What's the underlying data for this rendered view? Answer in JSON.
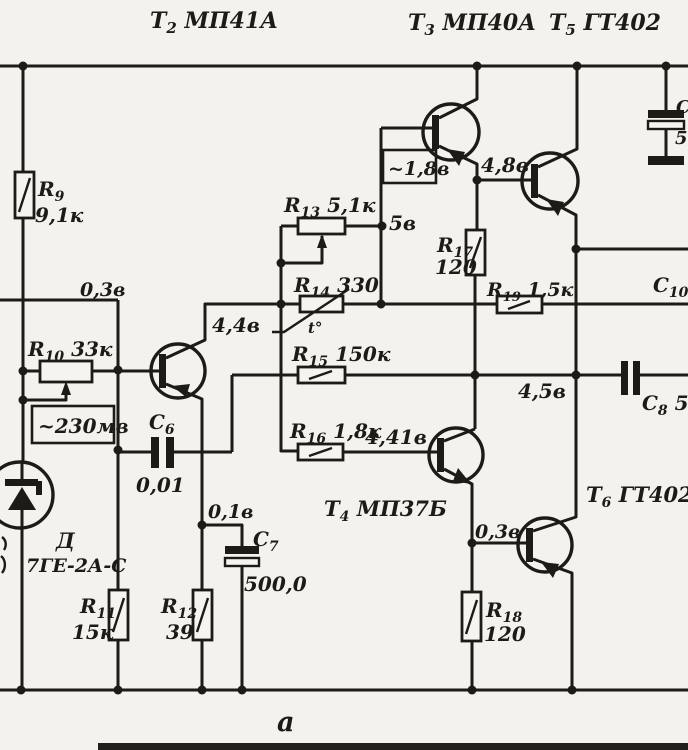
{
  "figure": {
    "caption": "а",
    "type": "transistor-amplifier-schematic",
    "colors": {
      "paper": "#f4f2ec",
      "ink": "#1c1b17"
    }
  },
  "labels": [
    {
      "name": "t2-designation",
      "x": 150,
      "y": 28,
      "size": 22,
      "pre": "Т",
      "sub": "2",
      "post": " МП41А"
    },
    {
      "name": "t3-designation",
      "x": 408,
      "y": 30,
      "size": 22,
      "pre": "Т",
      "sub": "3",
      "post": " МП40А"
    },
    {
      "name": "t5-designation",
      "x": 549,
      "y": 30,
      "size": 22,
      "pre": "Т",
      "sub": "5",
      "post": " ГТ402"
    },
    {
      "name": "r9-name",
      "x": 38,
      "y": 196,
      "size": 20,
      "pre": "R",
      "sub": "9"
    },
    {
      "name": "r9-value",
      "x": 35,
      "y": 222,
      "size": 20,
      "text": "9,1к"
    },
    {
      "name": "input-voltage",
      "x": 80,
      "y": 296,
      "size": 19,
      "text": "0,3в"
    },
    {
      "name": "r10-label",
      "x": 28,
      "y": 356,
      "size": 20,
      "pre": "R",
      "sub": "10",
      "post": " 33к"
    },
    {
      "name": "signal-level",
      "x": 38,
      "y": 433,
      "size": 20,
      "text": "~230мв"
    },
    {
      "name": "diode-name",
      "x": 56,
      "y": 548,
      "size": 21,
      "text": "Д"
    },
    {
      "name": "diode-type",
      "x": 26,
      "y": 572,
      "size": 19,
      "text": "7ГЕ-2А-С"
    },
    {
      "name": "r11-name",
      "x": 80,
      "y": 613,
      "size": 20,
      "pre": "R",
      "sub": "11"
    },
    {
      "name": "r11-value",
      "x": 72,
      "y": 639,
      "size": 20,
      "text": "15к"
    },
    {
      "name": "r12-name",
      "x": 161,
      "y": 613,
      "size": 20,
      "pre": "R",
      "sub": "12"
    },
    {
      "name": "r12-value",
      "x": 166,
      "y": 639,
      "size": 20,
      "text": "39"
    },
    {
      "name": "c6-name",
      "x": 149,
      "y": 429,
      "size": 20,
      "pre": "С",
      "sub": "6"
    },
    {
      "name": "c6-value",
      "x": 136,
      "y": 492,
      "size": 20,
      "text": "0,01"
    },
    {
      "name": "emitter-voltage",
      "x": 208,
      "y": 518,
      "size": 19,
      "text": "0,1в"
    },
    {
      "name": "c7-name",
      "x": 253,
      "y": 546,
      "size": 20,
      "pre": "С",
      "sub": "7"
    },
    {
      "name": "c7-value",
      "x": 244,
      "y": 591,
      "size": 20,
      "text": "500,0"
    },
    {
      "name": "t4-designation",
      "x": 324,
      "y": 516,
      "size": 21,
      "pre": "Т",
      "sub": "4",
      "post": " МП37Б"
    },
    {
      "name": "r13-label",
      "x": 284,
      "y": 212,
      "size": 20,
      "pre": "R",
      "sub": "13",
      "post": " 5,1к"
    },
    {
      "name": "v-5v",
      "x": 389,
      "y": 230,
      "size": 20,
      "text": "5в"
    },
    {
      "name": "r14-label",
      "x": 294,
      "y": 292,
      "size": 20,
      "pre": "R",
      "sub": "14",
      "post": " 330"
    },
    {
      "name": "thermo-mark",
      "x": 308,
      "y": 333,
      "size": 15,
      "text": "t°"
    },
    {
      "name": "r15-label",
      "x": 292,
      "y": 361,
      "size": 20,
      "pre": "R",
      "sub": "15",
      "post": " 150к"
    },
    {
      "name": "r16-label",
      "x": 290,
      "y": 438,
      "size": 20,
      "pre": "R",
      "sub": "16",
      "post": " 1,8к"
    },
    {
      "name": "v-4-41v",
      "x": 365,
      "y": 444,
      "size": 20,
      "text": "4,41в"
    },
    {
      "name": "v-4-4v",
      "x": 212,
      "y": 332,
      "size": 20,
      "text": "4,4в"
    },
    {
      "name": "boxed-1-8v",
      "x": 388,
      "y": 175,
      "size": 19,
      "text": "~1,8в"
    },
    {
      "name": "v-4-8v",
      "x": 481,
      "y": 172,
      "size": 20,
      "text": "4,8в"
    },
    {
      "name": "r17-name",
      "x": 437,
      "y": 252,
      "size": 20,
      "pre": "R",
      "sub": "17"
    },
    {
      "name": "r17-value",
      "x": 435,
      "y": 274,
      "size": 20,
      "text": "120"
    },
    {
      "name": "r19-label",
      "x": 487,
      "y": 296,
      "size": 19,
      "pre": "R",
      "sub": "19",
      "post": " 1,5к"
    },
    {
      "name": "c10-name",
      "x": 653,
      "y": 292,
      "size": 20,
      "pre": "С",
      "sub": "10"
    },
    {
      "name": "v-4-5v",
      "x": 518,
      "y": 398,
      "size": 20,
      "text": "4,5в"
    },
    {
      "name": "c8-label",
      "x": 642,
      "y": 410,
      "size": 20,
      "pre": "С",
      "sub": "8",
      "post": " 50"
    },
    {
      "name": "t6-designation",
      "x": 586,
      "y": 502,
      "size": 21,
      "pre": "Т",
      "sub": "6",
      "post": " ГТ402Б"
    },
    {
      "name": "t6-base-voltage",
      "x": 475,
      "y": 538,
      "size": 19,
      "text": "0,3в"
    },
    {
      "name": "r18-name",
      "x": 486,
      "y": 617,
      "size": 20,
      "pre": "R",
      "sub": "18"
    },
    {
      "name": "r18-value",
      "x": 484,
      "y": 641,
      "size": 20,
      "text": "120"
    },
    {
      "name": "figure-caption",
      "x": 277,
      "y": 731,
      "size": 27,
      "text": "а"
    },
    {
      "name": "c9-cutoff-name",
      "x": 676,
      "y": 113,
      "size": 18,
      "text": "С"
    },
    {
      "name": "c9-cutoff-value",
      "x": 675,
      "y": 144,
      "size": 18,
      "text": "5"
    }
  ]
}
